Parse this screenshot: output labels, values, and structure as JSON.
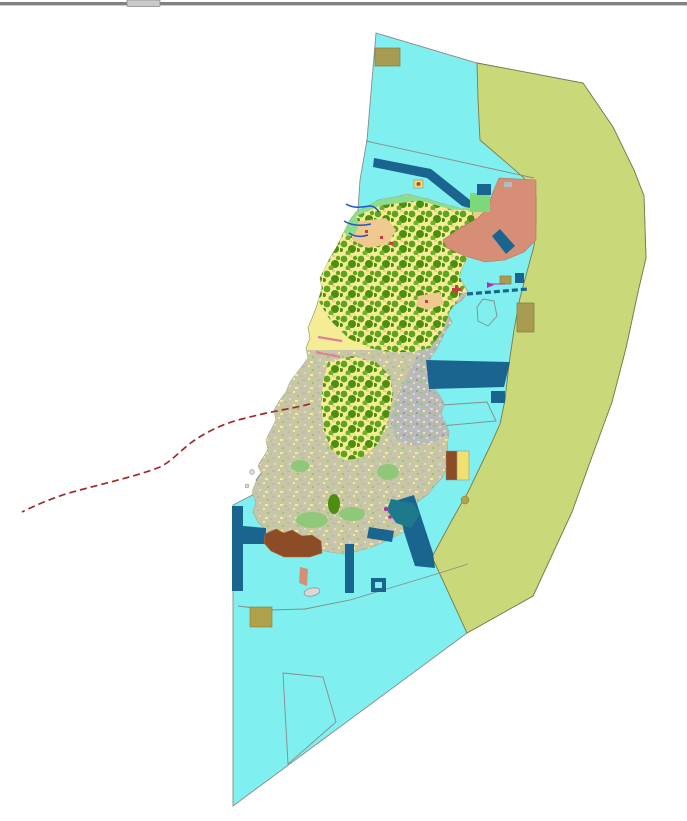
{
  "window": {
    "top_bar_color": "#818181",
    "top_tab_color": "#C9C9C9",
    "top_tab_border": "#8A8A8A"
  },
  "map": {
    "palette": {
      "background": "#FFFFFF",
      "water": "#80EFEF",
      "offshore_zone": "#C9D97A",
      "offshore_edge": "#7A7A4A",
      "island_base": "#F5ED96",
      "forest_green": "#5FA41E",
      "forest_green_dark": "#4C8E10",
      "forest_green_light": "#6FB22A",
      "urban_gray": "#B9B9B9",
      "urban_gray_light": "#D9D9D9",
      "speck_gray": "#9A9A9A",
      "south_mix": "#C9C6A6",
      "meadow_green": "#8FC878",
      "coast_green": "#8EDC8E",
      "park_green": "#7BD87B",
      "tan_village": "#EFC98E",
      "village_red": "#C44040",
      "salmon_zone": "#D68F76",
      "salmon_edge": "#B0765E",
      "navy": "#1A6490",
      "teal_bay": "#1C7A8C",
      "khaki_parcel": "#A89B52",
      "khaki_parcel_bright": "#AFA04A",
      "khaki_edge": "#8A7C30",
      "brown_area": "#8C4D26",
      "brown_edge": "#C06030",
      "shallow_blue": "#AED9F2",
      "stream_blue": "#2255CC",
      "pink_pier": "#E08098",
      "magenta_mark": "#B030B0",
      "marker_yellow": "#EFE070",
      "red_boundary": "#9E2B2B",
      "line_gray": "#8A8A8A",
      "islet_gray": "#D8D8D8"
    },
    "features": [
      "water-area",
      "offshore-buffer-zone",
      "island-landmass",
      "north-forest-mosaic",
      "urban-mosaic",
      "central-forest-cluster",
      "south-landuse-mosaic",
      "northeast-coastal-zone",
      "harbor-structures",
      "offshore-parcels",
      "south-reclaimed-area",
      "maritime-dashed-boundary"
    ]
  }
}
